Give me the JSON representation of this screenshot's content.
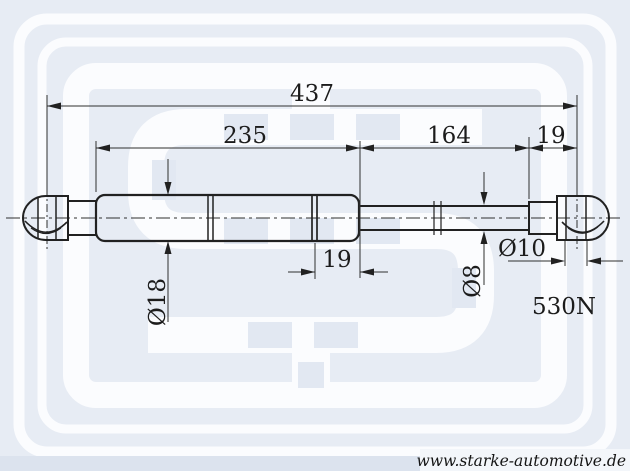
{
  "dimensions": {
    "total_length": "437",
    "cylinder_length": "235",
    "rod_length": "164",
    "right_eyelet_length": "19",
    "cylinder_end_segment": "19",
    "cylinder_diameter": "Ø18",
    "rod_diameter": "Ø8",
    "eyelet_bore_diameter": "Ø10"
  },
  "force_rating": "530N",
  "footer": {
    "website": "www.starke-automotive.de"
  },
  "colors": {
    "background": "#e7ecf4",
    "watermark_white": "#fbfcfe",
    "watermark_window": "#e2e8f2",
    "line": "#212121",
    "text": "#1c1c1c",
    "footer_strip": "#dce3ee"
  }
}
